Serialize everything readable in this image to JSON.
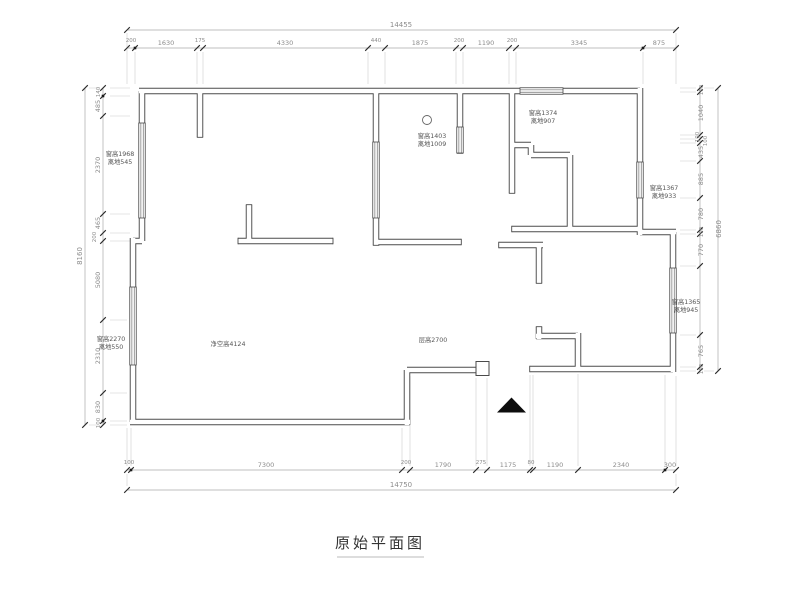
{
  "title": "原始平面图",
  "colors": {
    "wall": "#4a4a4a",
    "dim_line": "#aaaaaa",
    "dim_text": "#8c8c8c",
    "annotation_text": "#555555",
    "entry_marker": "#0d0d0d"
  },
  "dims": {
    "top_total": "14455",
    "top_segs": [
      "200",
      "1630",
      "175",
      "4330",
      "440",
      "1875",
      "200",
      "1190",
      "200",
      "3345",
      "875"
    ],
    "bottom_segs": [
      "100",
      "7300",
      "200",
      "1790",
      "275",
      "1175",
      "80",
      "1190",
      "2340",
      "300"
    ],
    "bottom_total": "14750",
    "left_total": "8160",
    "left_segs": [
      "140",
      "485",
      "2370",
      "465",
      "200",
      "5080",
      "2310",
      "830",
      "100"
    ],
    "right_total": "6860",
    "right_segs": [
      "100",
      "1040",
      "100",
      "100",
      "435",
      "885",
      "780",
      "100",
      "770",
      "765",
      "100"
    ]
  },
  "annotations": {
    "left_window": {
      "line1": "窗高1968",
      "line2": "离地545"
    },
    "left_lower_window": {
      "line1": "窗高2270",
      "line2": "离地550"
    },
    "kitchen_window": {
      "line1": "窗高1403",
      "line2": "离地1009"
    },
    "top_right_window": {
      "line1": "窗高1374",
      "line2": "离地907"
    },
    "right_upper_window": {
      "line1": "窗高1367",
      "line2": "离地933"
    },
    "right_lower_window": {
      "line1": "窗高1365",
      "line2": "离地945"
    },
    "clear_height": "净空高4124",
    "room_height": "层高2700"
  }
}
